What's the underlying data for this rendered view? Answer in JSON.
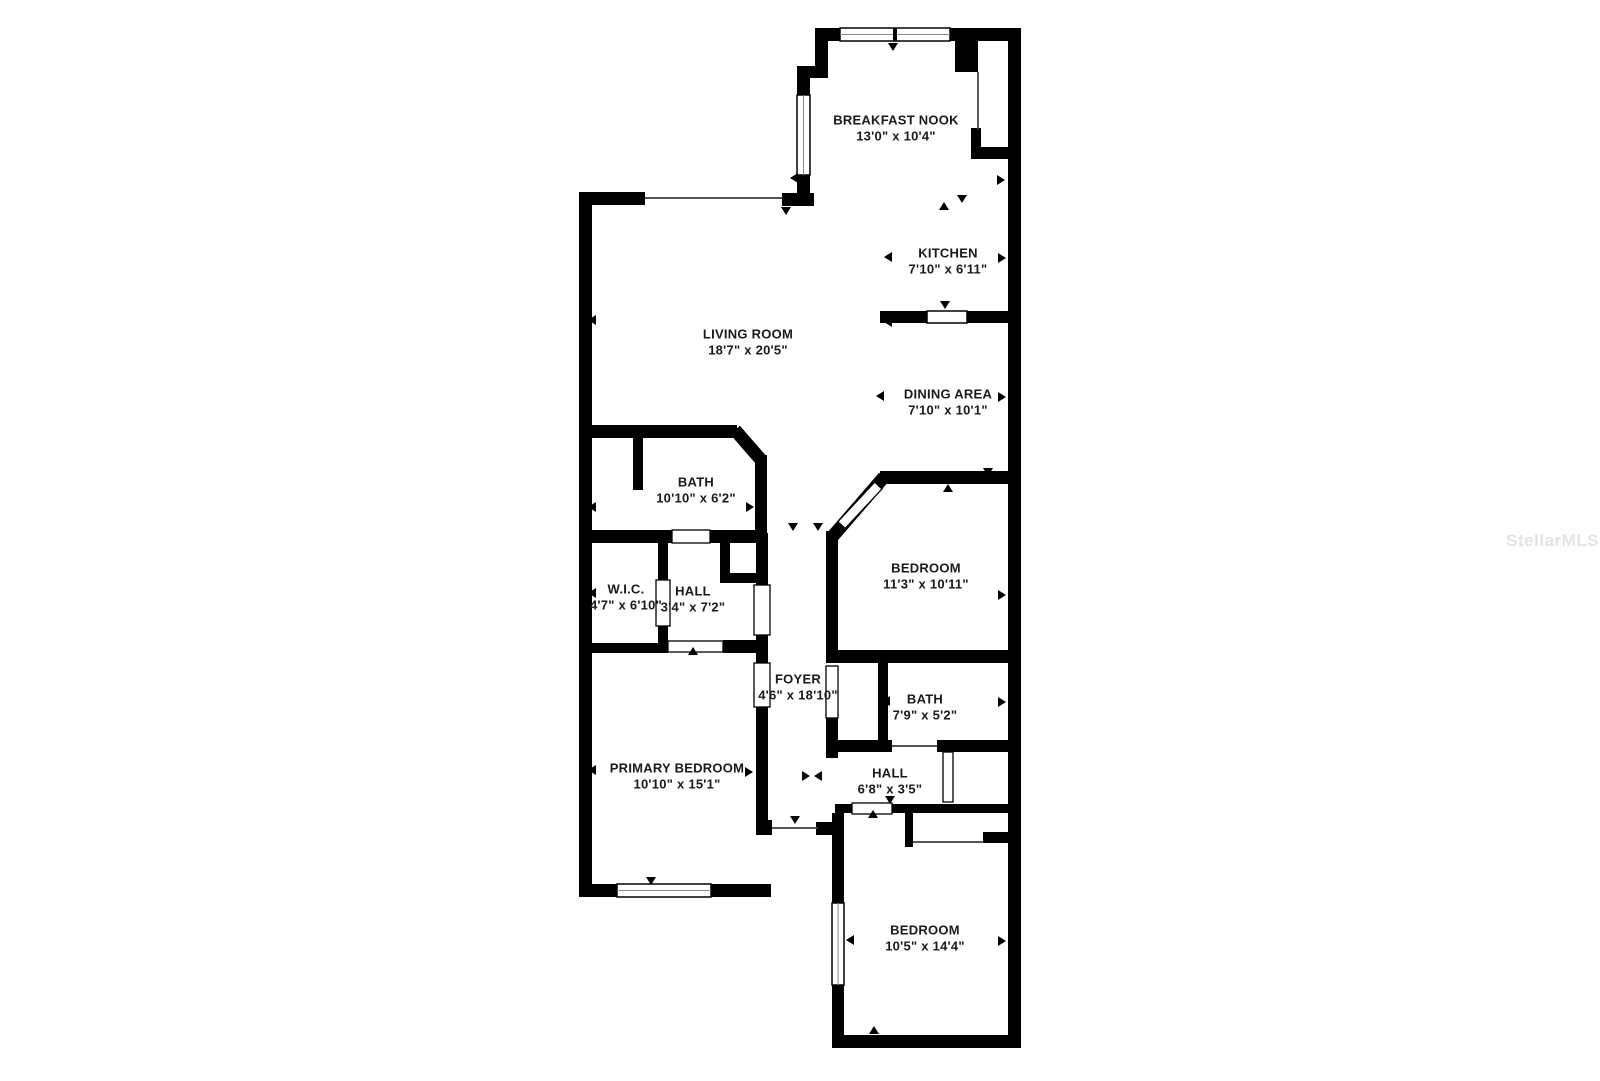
{
  "watermark": "StellarMLS",
  "colors": {
    "wall": "#000000",
    "text": "#1a1a1a",
    "watermark": "#e3e3e3",
    "background": "#ffffff"
  },
  "rooms": [
    {
      "id": "breakfast-nook",
      "name": "BREAKFAST NOOK",
      "dims": "13'0\" x 10'4\""
    },
    {
      "id": "kitchen",
      "name": "KITCHEN",
      "dims": "7'10\" x 6'11\""
    },
    {
      "id": "living-room",
      "name": "LIVING ROOM",
      "dims": "18'7\" x 20'5\""
    },
    {
      "id": "dining-area",
      "name": "DINING AREA",
      "dims": "7'10\" x 10'1\""
    },
    {
      "id": "bath-upper",
      "name": "BATH",
      "dims": "10'10\" x 6'2\""
    },
    {
      "id": "wic",
      "name": "W.I.C.",
      "dims": "4'7\" x 6'10\""
    },
    {
      "id": "hall-upper",
      "name": "HALL",
      "dims": "3'4\" x 7'2\""
    },
    {
      "id": "foyer",
      "name": "FOYER",
      "dims": "4'6\" x 18'10\""
    },
    {
      "id": "bedroom-middle",
      "name": "BEDROOM",
      "dims": "11'3\" x 10'11\""
    },
    {
      "id": "bath-lower",
      "name": "BATH",
      "dims": "7'9\" x 5'2\""
    },
    {
      "id": "hall-lower",
      "name": "HALL",
      "dims": "6'8\" x 3'5\""
    },
    {
      "id": "primary-bedroom",
      "name": "PRIMARY BEDROOM",
      "dims": "10'10\" x 15'1\""
    },
    {
      "id": "bedroom-lower",
      "name": "BEDROOM",
      "dims": "10'5\" x 14'4\""
    }
  ]
}
